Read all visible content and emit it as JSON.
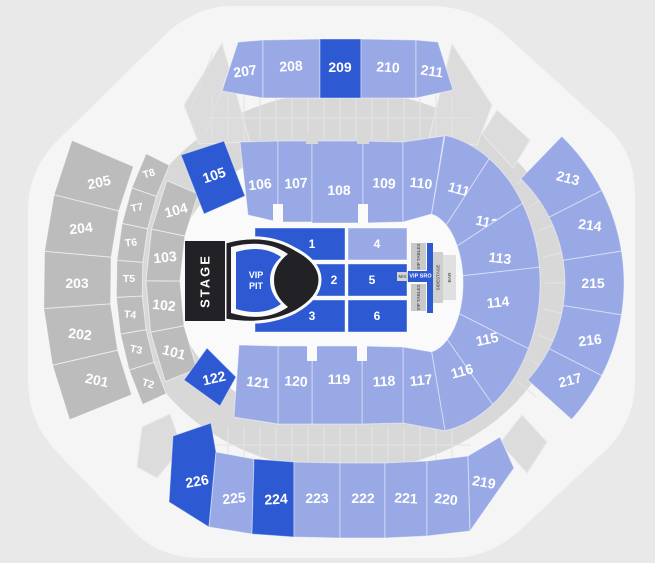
{
  "map_title": "arena-seat-map",
  "sections": {
    "top_200": [
      "207",
      "208",
      "209",
      "210",
      "211"
    ],
    "left_200": [
      "201",
      "202",
      "203",
      "204",
      "205"
    ],
    "t_level": [
      "T2",
      "T3",
      "T4",
      "T5",
      "T6",
      "T7",
      "T8"
    ],
    "left_100": [
      "101",
      "102",
      "103",
      "104"
    ],
    "inner_top": [
      "105",
      "106",
      "107",
      "108",
      "109",
      "110"
    ],
    "fan_right": [
      "111",
      "112",
      "113",
      "114",
      "115",
      "116"
    ],
    "inner_bottom": [
      "117",
      "118",
      "119",
      "120",
      "121",
      "122"
    ],
    "right_200": [
      "213",
      "214",
      "215",
      "216",
      "217"
    ],
    "bottom_200": [
      "219",
      "220",
      "221",
      "222",
      "223",
      "224",
      "225",
      "226"
    ],
    "floor": [
      "1",
      "2",
      "3",
      "4",
      "5",
      "6"
    ]
  },
  "floor_labels": {
    "stage": "STAGE",
    "vip_line1": "VIP",
    "vip_line2": "PIT",
    "mix": "MIX",
    "vip_sro": "VIP SRO",
    "vip_tables_top": "VIP TABLES",
    "vip_tables_bottom": "VIP TABLES",
    "sidestage": "SIDESTAGE",
    "bar": "BAR"
  },
  "highlighted_sections": [
    "209",
    "105",
    "122",
    "224",
    "226",
    "1",
    "2",
    "3",
    "5",
    "6",
    "VIP PIT",
    "VIP SRO"
  ],
  "colors": {
    "section_available": "#98A9E6",
    "section_selected": "#2D5AD3",
    "section_unavailable": "#BCBCBC",
    "stage": "#212126",
    "background": "#E9E9E9",
    "concourse": "#F5F5F5",
    "walkway": "#D8D8D8",
    "floor": "#FAFAFA"
  }
}
